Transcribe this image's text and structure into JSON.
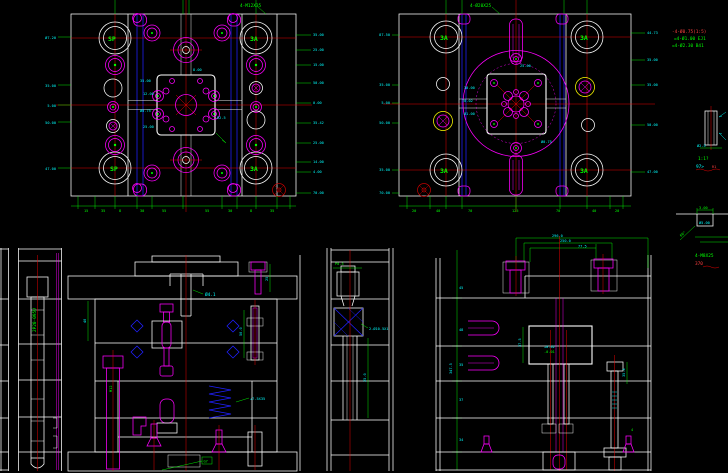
{
  "app": {
    "name": "cad-mold-drawing",
    "background": "#000000"
  },
  "colors": {
    "outline": "#ffffff",
    "magenta": "#ff00ff",
    "red": "#ff0000",
    "green": "#00ff00",
    "cyan": "#00ffff",
    "blue": "#2020ff",
    "yellow": "#ffff00",
    "dark_red": "#bb0000",
    "hatch": "#b8b8b8"
  },
  "viewA": {
    "corner_tl": "SP",
    "corner_tr": "3A",
    "corner_bl": "SP",
    "corner_br": "3A",
    "note": "4-M12X35",
    "left_labels": [
      "Ø7.20",
      "35.00",
      "5.00",
      "50.00",
      "47.00"
    ],
    "right_labels": [
      "35.00",
      "25.00",
      "15.00",
      "50.00",
      "0.00",
      "35.42",
      "25.00",
      "14.00",
      "4.00",
      "70.00"
    ],
    "bottom_ticks": [
      "15",
      "35",
      "8",
      "30",
      "55",
      "55",
      "30",
      "8",
      "35"
    ],
    "cavity_labels": [
      "35.00",
      "12.00",
      "Ø0.75",
      "25.00",
      "8.00",
      "R2.5"
    ]
  },
  "viewB": {
    "corner_tl": "3A",
    "corner_tr": "3A",
    "corner_bl": "3A",
    "corner_br": "3A",
    "note": "4-Ø20X25",
    "left_labels": [
      "87.50",
      "35.00",
      "5.00",
      "50.00",
      "35.00",
      "70.00"
    ],
    "right_labels": [
      "44.73",
      "35.00",
      "35.00",
      "50.00",
      "47.00"
    ],
    "bottom_ticks": [
      "20",
      "40",
      "70",
      "125",
      "70",
      "40",
      "20"
    ],
    "center_labels": [
      "30.00",
      "T0.02",
      "Ø1.00",
      "25.00",
      "Ø0.75"
    ]
  },
  "notes": {
    "line1": "-4-Ø0.75(1:5)",
    "line2": "=4-Ø1.00 EJ1",
    "line3": "=4-Ø2.30 B41"
  },
  "detail_pin": {
    "scale_label": "1:1?",
    "sub_label": "97>",
    "ref": "R1",
    "dim": "Ø2.5"
  },
  "detail_gate": {
    "dim_top": "3.00",
    "dim_mid": "Ø5.00",
    "dim_angle": "60°"
  },
  "sectionD": {
    "part_no": "2P20-095U"
  },
  "sectionE": {
    "sprue_dim": "Ø4.1",
    "spring_note": "+7.5X35",
    "pin_dim": "50.0",
    "bolt_dim": "25",
    "screw_label": "M12",
    "plate_dim": "40",
    "box_label": "G7"
  },
  "sectionF": {
    "top_dim": "P0.5",
    "side_note": "2-Ø10.5X1",
    "depth_dim": "25.0",
    "height_dim": "347.5"
  },
  "sectionG": {
    "chain1": "296.0",
    "chain2": "250.0",
    "chain3": "77.5",
    "block_dim": "37.5",
    "block_tol": "+0.02",
    "block_tol2": "-0.01",
    "stack": [
      "45",
      "48",
      "35",
      "37",
      "34"
    ],
    "right_dim": "35.4",
    "foot_dim": "4",
    "note_green": "4-M8X25",
    "note_red": "370"
  }
}
